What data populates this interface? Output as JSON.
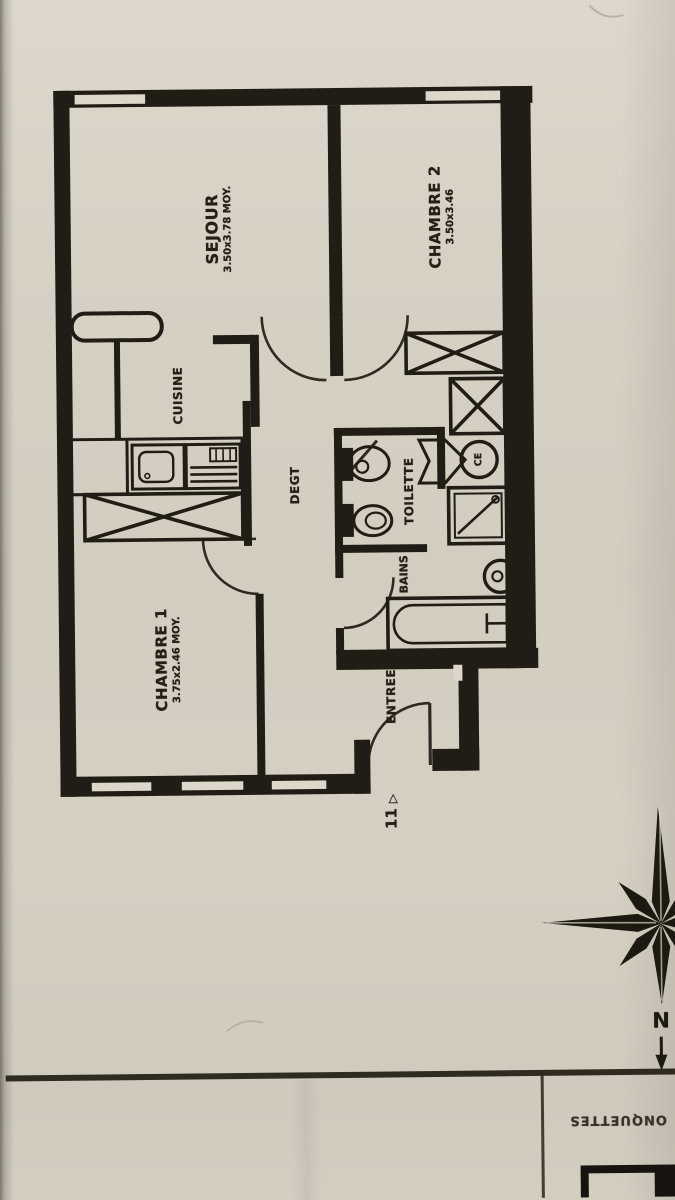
{
  "document": {
    "kind": "floor-plan-scan",
    "paper_color": "#d6d0c3",
    "ink_color": "#221d14"
  },
  "rooms": {
    "sejour": {
      "name": "SEJOUR",
      "dims": "3.50x3.78 MOY."
    },
    "chambre2": {
      "name": "CHAMBRE 2",
      "dims": "3.50x3.46"
    },
    "cuisine": {
      "name": "CUISINE"
    },
    "degagement": {
      "name": "DEGT"
    },
    "toilette": {
      "name": "TOILETTE"
    },
    "bains": {
      "name": "BAINS"
    },
    "chambre1": {
      "name": "CHAMBRE 1",
      "dims": "3.75x2.46 MOY."
    },
    "entree": {
      "name": "ENTREE"
    }
  },
  "annotations": {
    "door_number": "11",
    "door_arrow": "▷",
    "water_heater_label": "CE",
    "compass_north": "N",
    "title_block_text": "ONQUETTES"
  }
}
